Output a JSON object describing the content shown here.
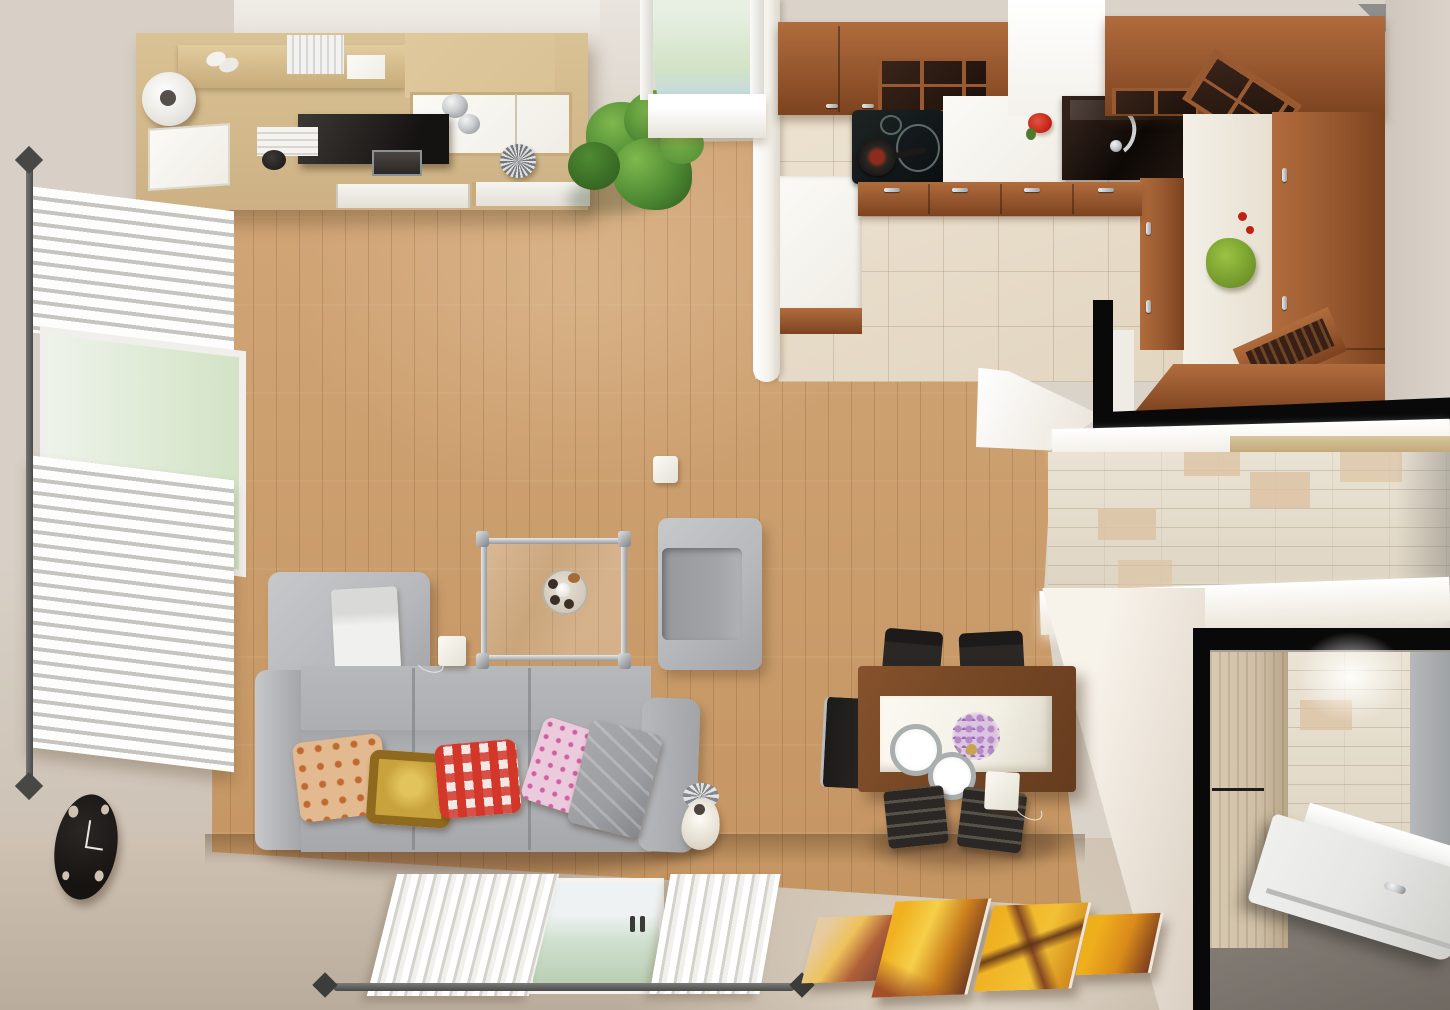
{
  "meta": {
    "title": "Top-down 3D interior render of a studio apartment",
    "view": "overhead (bird's-eye) architectural rendering",
    "rooms": [
      "living room",
      "open kitchen",
      "hallway",
      "entry"
    ]
  },
  "palette": {
    "wall": "#dad3c9",
    "wall-left": "#d8d0c6",
    "wallb-a": "#cfc2b3",
    "wallb-b": "#baac9c",
    "ceiling": "#f0ede8",
    "rwall-a": "#f7f2ea",
    "rwall-b": "#d9cec0",
    "floor-a": "#d4a97c",
    "floor-b": "#c3935f",
    "plank": "rgba(70,40,10,.16)",
    "partition": "#f3f1ea",
    "tilek": "#ece2d0",
    "tilek-line": "rgba(165,145,115,.35)",
    "cherry": "#9a5a31",
    "cherry-l": "#b06c3c",
    "cherry-d": "#7c431f",
    "counter": "#f6f4ee",
    "sink-a": "#32211a",
    "sink-b": "#0e0906",
    "cooktop": "#12181a",
    "pan-red": "#8e2c1c",
    "unit": "#d9c295",
    "unit-d": "#c7ab7a",
    "whitec": "#f0ede6",
    "tv": "#282422",
    "chrome-a": "#c9ccce",
    "chrome-b": "#84878a",
    "plant-a": "#4e8a33",
    "plant-b": "#2d5a1c",
    "plant-c": "#7fb84e",
    "sofa": "#b6b8bb",
    "sofa-d": "#a2a4a8",
    "sofa-l": "#c6c8ca",
    "pil-or": "#e3b98f",
    "pil-or2": "#c06a2f",
    "pil-gd": "#c8a23c",
    "pil-gd2": "#8f6a1e",
    "pil-rd": "#d2372a",
    "pil-pk": "#eccadd",
    "pil-pk2": "#d05f9f",
    "throw": "#9b9da1",
    "glass-a": "#e8f0e4",
    "glass-b": "#d2e3c6",
    "glass-c": "#eef2f3",
    "twood": "#744624",
    "ttop": "#f3f0e6",
    "chair": "#2a2725",
    "clock": "#161311",
    "art-a": "#eead1e",
    "art-b": "#c97c1c",
    "art-c": "#7a3c20",
    "art-d": "#e6cba0",
    "tilew": "#eae3d4",
    "tilew-acc": "#dcc3a4",
    "blackc": "#090909",
    "entry-floor": "#8e8780",
    "wardrobe": "#cfbfa6",
    "door": "#e6e6e4",
    "gwall": "#9fa2a4",
    "blind-a": "#fdfdfc",
    "blind-b": "#c6c4bf",
    "rod": "#4a4a48",
    "bowl-a": "#9cc244",
    "bowl-b": "#6d9427",
    "red": "#c22017"
  },
  "labels": {
    "sofa": "Gray three-seat sofa with cushions",
    "chaise": "Chaise cushion with folded white throw",
    "pillow_orange": "Orange patterned pillow",
    "pillow_gold": "Gold ornamental pillow",
    "pillow_red": "Red gingham pillow",
    "pillow_pink": "Pink patterned pillow",
    "coffee_table": "Square glass coffee table with chrome frame",
    "candle_tray": "Round tray with candles",
    "armchair": "Gray armchair",
    "floor_lamp": "Floor lamp with cream shade",
    "wall_unit": "Light wood wall unit with TV and decor",
    "tv": "Flat-screen TV",
    "plant": "Potted green plant",
    "clock": "Black wall clock",
    "dining_table": "Wood dining table with white inset top",
    "dining_chair": "Dark dining chair",
    "plate": "Place setting plate",
    "flowers": "Purple flower centerpiece",
    "cooktop": "Black induction cooktop with frying pan",
    "sink": "Dark countertop with chrome sink faucet",
    "kitchen_cabinets": "Cherry wood kitchen cabinets",
    "green_bowl": "Green salad bowl",
    "window_left": "Window with white blinds",
    "window_top": "Tall window with green glass",
    "window_bottom": "Balcony window with white curtains",
    "artwork": "Four-panel yellow abstract artwork",
    "entry_door": "Open white entry door",
    "wardrobe": "Light wood wardrobe",
    "light_switch": "Wall switch"
  }
}
